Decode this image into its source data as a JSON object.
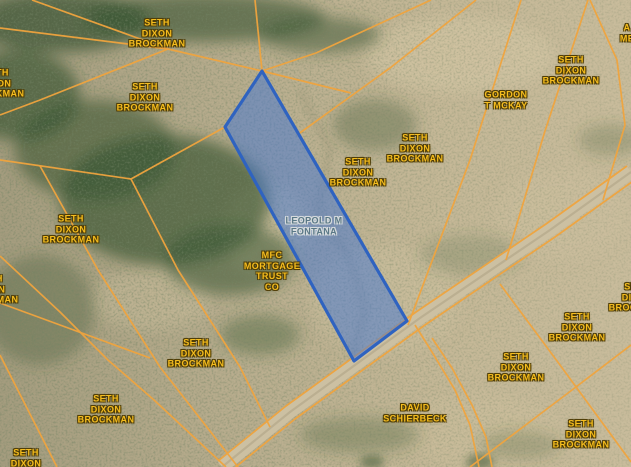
{
  "map": {
    "type": "parcel-map-satellite-view",
    "colors": {
      "parcel_line": "#f0a43e",
      "owner_label_text": "#f6bd1e",
      "owner_label_outline": "#503e07",
      "selected_fill": "rgba(66,118,214,0.5)",
      "selected_border": "#2f63c0",
      "selected_label_text": "#5a7886",
      "selected_label_outline": "#d6dbdd",
      "road_fill": "#ccc0a2",
      "road_track": "#b6aa8d"
    },
    "selected_parcel": {
      "owner": "LEOPOLD M FONTANA",
      "polygon": [
        [
          262,
          71
        ],
        [
          225,
          127
        ],
        [
          354,
          361
        ],
        [
          407,
          321
        ]
      ],
      "label": {
        "lines": [
          "LEOPOLD M",
          "FONTANA"
        ],
        "x": 314,
        "y": 226
      }
    },
    "labels": [
      {
        "lines": [
          "SETH",
          "DIXON",
          "BROCKMAN"
        ],
        "x": 157,
        "y": 33
      },
      {
        "lines": [
          "SETH",
          "DIXON",
          "BROCKMAN"
        ],
        "x": -4,
        "y": 83
      },
      {
        "lines": [
          "SETH",
          "DIXON",
          "BROCKMAN"
        ],
        "x": 145,
        "y": 97
      },
      {
        "lines": [
          "SETH",
          "DIXON",
          "BROCKMAN"
        ],
        "x": 415,
        "y": 148
      },
      {
        "lines": [
          "GORDON",
          "T MCKAY"
        ],
        "x": 506,
        "y": 100
      },
      {
        "lines": [
          "SETH",
          "DIXON",
          "BROCKMAN"
        ],
        "x": 571,
        "y": 70
      },
      {
        "lines": [
          "A",
          "ME"
        ],
        "x": 627,
        "y": 33
      },
      {
        "lines": [
          "SETH",
          "DIXON",
          "BROCKMAN"
        ],
        "x": 358,
        "y": 172
      },
      {
        "lines": [
          "SETH",
          "DIXON",
          "BROCKMAN"
        ],
        "x": 71,
        "y": 229
      },
      {
        "lines": [
          "SETH",
          "DIXON",
          "BROCKMAN"
        ],
        "x": -10,
        "y": 289
      },
      {
        "lines": [
          "MFC",
          "MORTGAGE",
          "TRUST",
          "CO"
        ],
        "x": 272,
        "y": 271
      },
      {
        "lines": [
          "SETH",
          "DIXON",
          "BROCKMAN"
        ],
        "x": 196,
        "y": 353
      },
      {
        "lines": [
          "SETH",
          "DIXON",
          "BROCKMAN"
        ],
        "x": 106,
        "y": 409
      },
      {
        "lines": [
          "SETH",
          "DIXON",
          "BROCKMAN"
        ],
        "x": 26,
        "y": 463
      },
      {
        "lines": [
          "SETH",
          "DIXON",
          "BROCKMAN"
        ],
        "x": 637,
        "y": 297
      },
      {
        "lines": [
          "SETH",
          "DIXON",
          "BROCKMAN"
        ],
        "x": 577,
        "y": 327
      },
      {
        "lines": [
          "SETH",
          "DIXON",
          "BROCKMAN"
        ],
        "x": 516,
        "y": 367
      },
      {
        "lines": [
          "DAVID",
          "SCHIERBECK"
        ],
        "x": 415,
        "y": 413
      },
      {
        "lines": [
          "SETH",
          "DIXON",
          "BROCKMAN"
        ],
        "x": 581,
        "y": 434
      }
    ],
    "road": {
      "centerline": [
        [
          631,
          172
        ],
        [
          550,
          230
        ],
        [
          420,
          318
        ],
        [
          290,
          412
        ],
        [
          222,
          467
        ]
      ],
      "flanks": [
        [
          [
            627,
            166
          ],
          [
            546,
            224
          ],
          [
            416,
            312
          ],
          [
            286,
            406
          ],
          [
            218,
            461
          ]
        ],
        [
          [
            636,
            179
          ],
          [
            555,
            237
          ],
          [
            425,
            325
          ],
          [
            295,
            419
          ],
          [
            227,
            474
          ]
        ]
      ]
    },
    "parcel_lines": [
      [
        [
          0,
          28
        ],
        [
          168,
          49
        ],
        [
          262,
          71
        ]
      ],
      [
        [
          32,
          0
        ],
        [
          168,
          49
        ]
      ],
      [
        [
          168,
          49
        ],
        [
          40,
          100
        ],
        [
          0,
          115
        ]
      ],
      [
        [
          255,
          0
        ],
        [
          262,
          71
        ]
      ],
      [
        [
          431,
          0
        ],
        [
          316,
          53
        ],
        [
          262,
          71
        ]
      ],
      [
        [
          0,
          160
        ],
        [
          131,
          179
        ]
      ],
      [
        [
          131,
          179
        ],
        [
          225,
          127
        ]
      ],
      [
        [
          262,
          71
        ],
        [
          351,
          93
        ]
      ],
      [
        [
          476,
          0
        ],
        [
          390,
          68
        ],
        [
          297,
          135
        ]
      ],
      [
        [
          521,
          0
        ],
        [
          470,
          160
        ],
        [
          408,
          325
        ]
      ],
      [
        [
          588,
          0
        ],
        [
          545,
          131
        ],
        [
          506,
          260
        ]
      ],
      [
        [
          590,
          0
        ],
        [
          617,
          60
        ],
        [
          625,
          125
        ],
        [
          603,
          200
        ]
      ],
      [
        [
          500,
          284
        ],
        [
          560,
          365
        ],
        [
          631,
          462
        ]
      ],
      [
        [
          631,
          345
        ],
        [
          572,
          390
        ],
        [
          470,
          467
        ]
      ],
      [
        [
          131,
          179
        ],
        [
          178,
          270
        ],
        [
          240,
          367
        ],
        [
          270,
          427
        ]
      ],
      [
        [
          40,
          166
        ],
        [
          98,
          270
        ],
        [
          160,
          367
        ],
        [
          238,
          467
        ]
      ],
      [
        [
          0,
          256
        ],
        [
          60,
          312
        ],
        [
          108,
          360
        ],
        [
          154,
          400
        ],
        [
          226,
          467
        ]
      ],
      [
        [
          0,
          355
        ],
        [
          32,
          418
        ],
        [
          57,
          467
        ]
      ],
      [
        [
          0,
          303
        ],
        [
          60,
          325
        ],
        [
          150,
          358
        ]
      ],
      [
        [
          415,
          325
        ],
        [
          432,
          352
        ],
        [
          455,
          390
        ],
        [
          470,
          425
        ],
        [
          479,
          467
        ]
      ],
      [
        [
          432,
          338
        ],
        [
          452,
          368
        ],
        [
          472,
          405
        ],
        [
          486,
          437
        ],
        [
          492,
          467
        ]
      ]
    ],
    "drainage_trace": [
      [
        300,
        90
      ],
      [
        330,
        150
      ],
      [
        318,
        210
      ],
      [
        350,
        260
      ],
      [
        365,
        310
      ],
      [
        352,
        358
      ]
    ]
  }
}
